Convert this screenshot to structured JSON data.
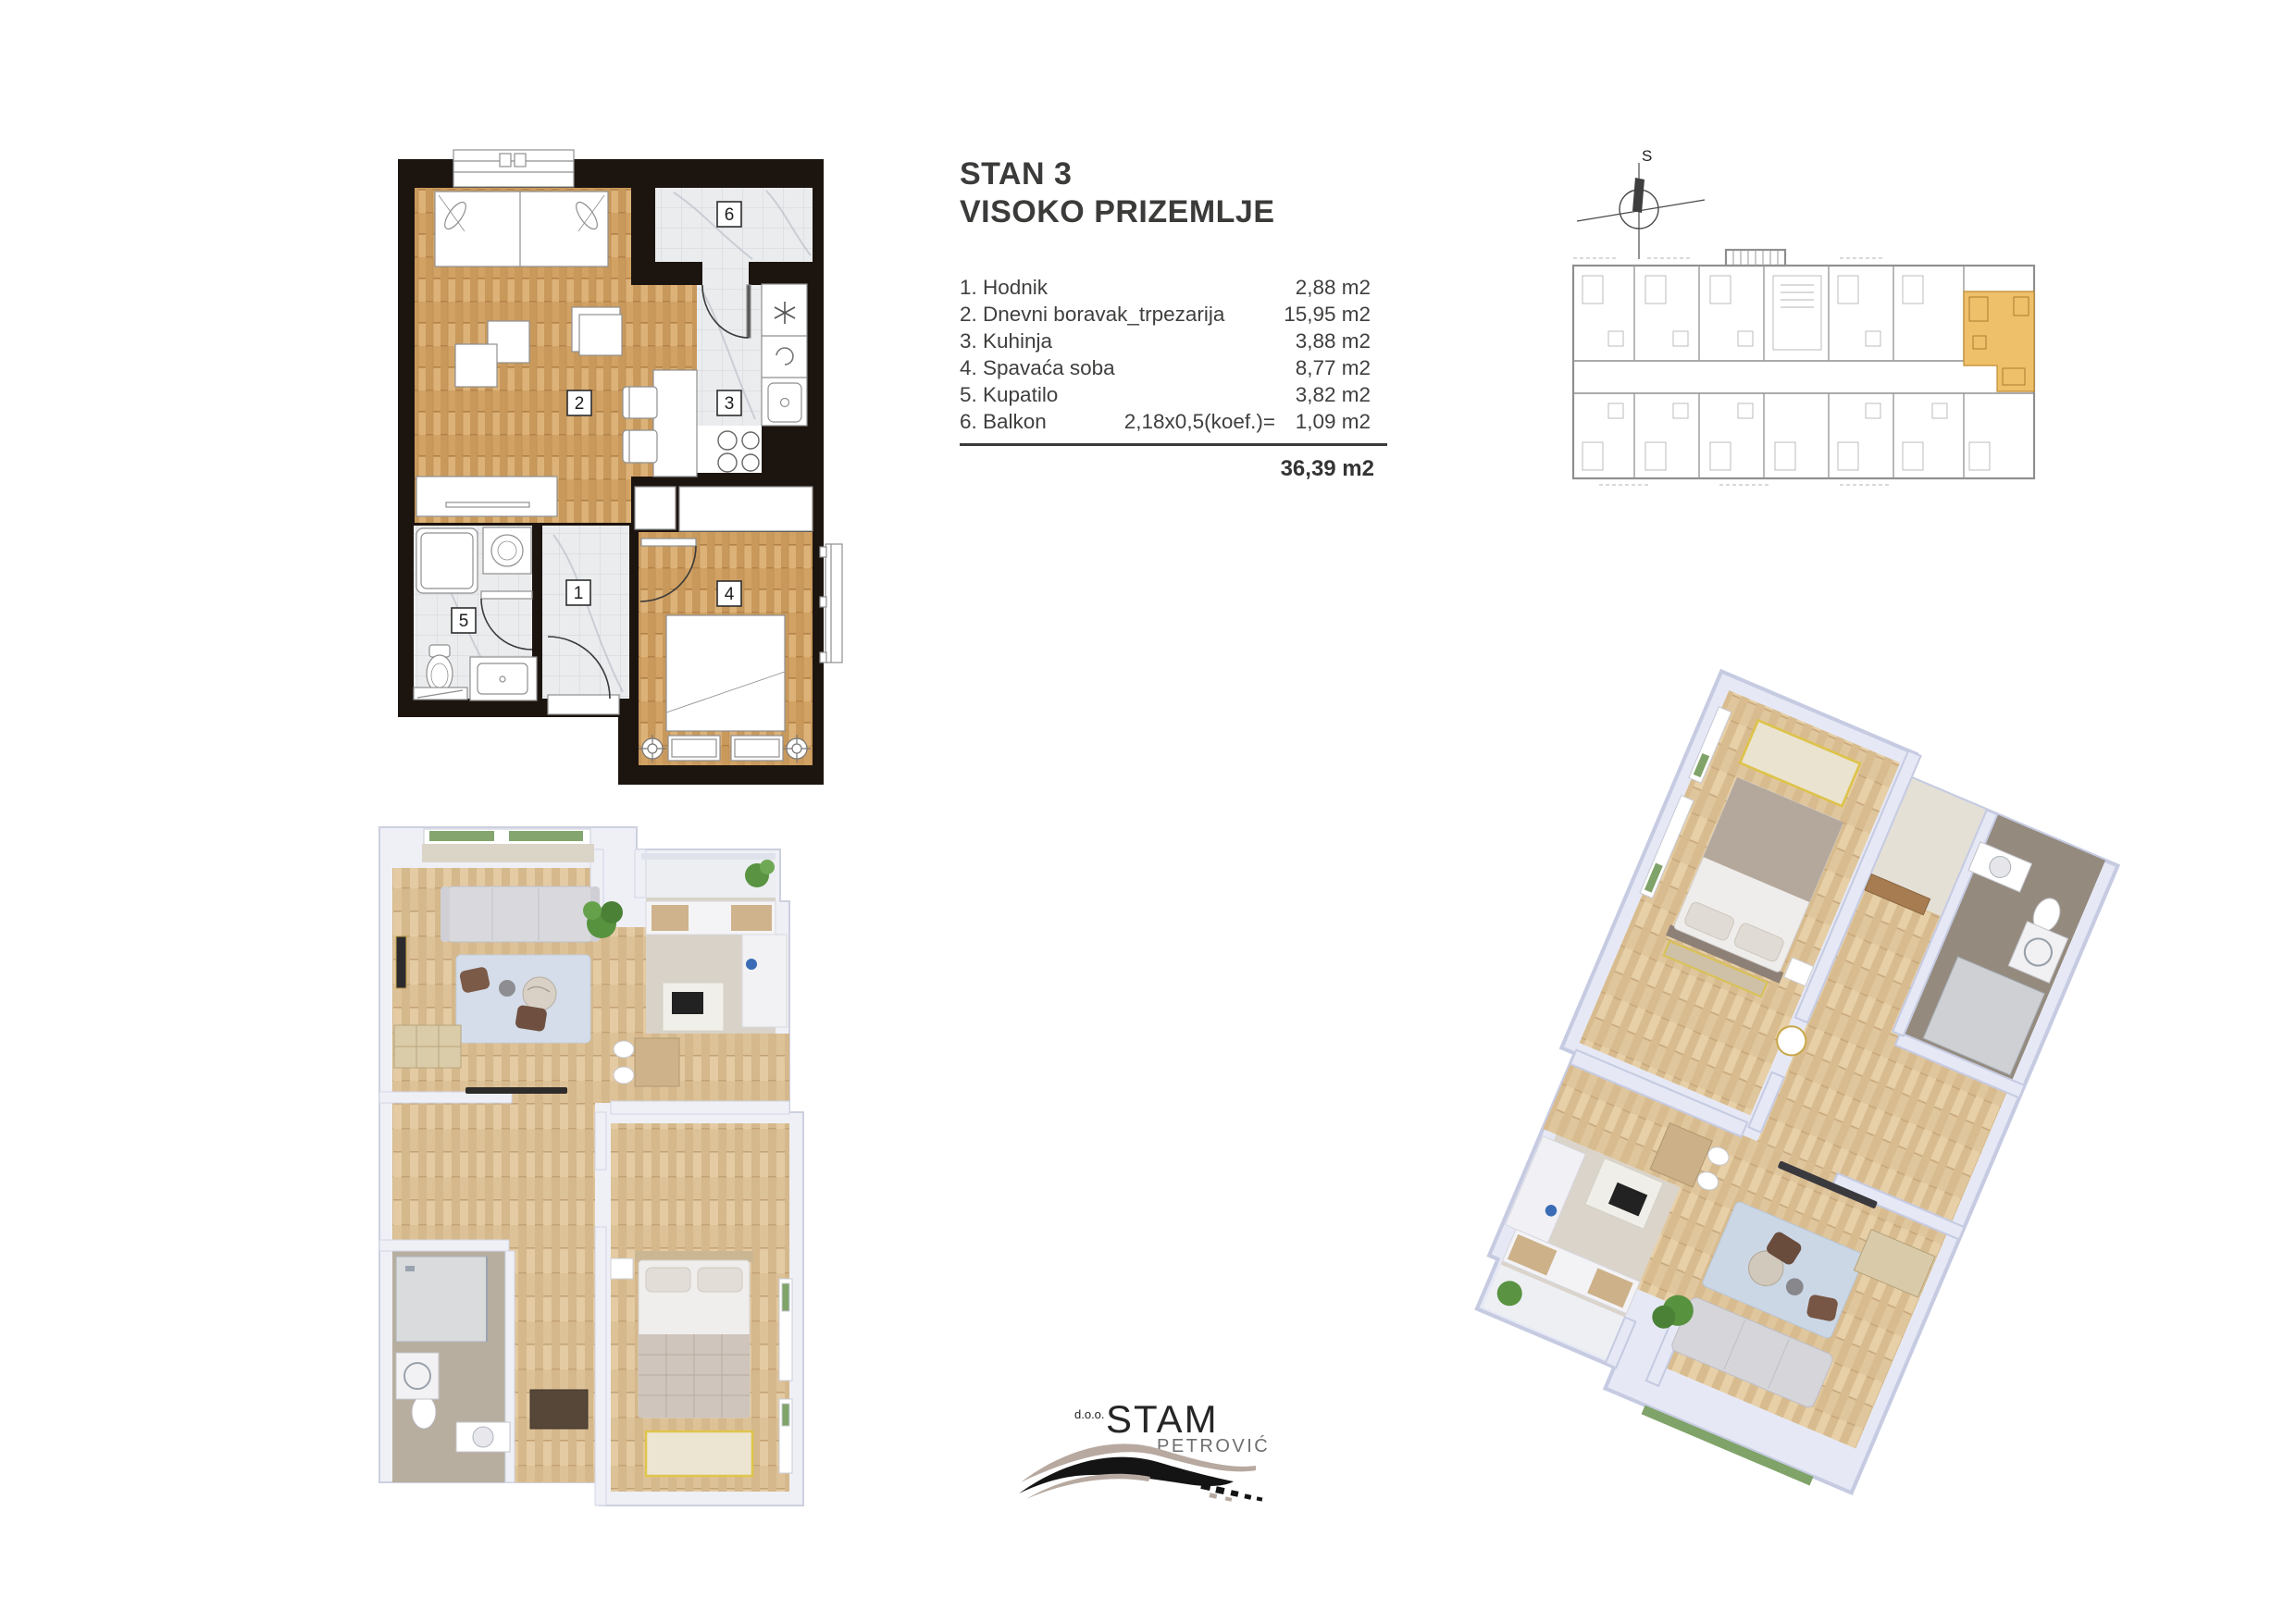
{
  "page": {
    "background": "#ffffff"
  },
  "info": {
    "title": "STAN 3",
    "subtitle": "VISOKO PRIZEMLJE",
    "rooms": [
      {
        "label": "1. Hodnik",
        "formula": "",
        "area": "2,88 m2"
      },
      {
        "label": "2. Dnevni boravak_trpezarija",
        "formula": "",
        "area": "15,95 m2"
      },
      {
        "label": "3. Kuhinja",
        "formula": "",
        "area": "3,88 m2"
      },
      {
        "label": "4. Spavaća soba",
        "formula": "",
        "area": "8,77 m2"
      },
      {
        "label": "5. Kupatilo",
        "formula": "",
        "area": "3,82 m2"
      },
      {
        "label": "6. Balkon",
        "formula": "2,18x0,5(koef.)=",
        "area": "1,09 m2"
      }
    ],
    "total": "36,39 m2"
  },
  "plan2d": {
    "labels": [
      "1",
      "2",
      "3",
      "4",
      "5",
      "6"
    ],
    "colors": {
      "wall": "#1c140f",
      "wood": "#d1a263",
      "tile": "#ebecee"
    }
  },
  "key_plan": {
    "compass_label": "S",
    "highlight_color": "#eec06a"
  },
  "logo": {
    "prefix": "d.o.o.",
    "name": "STAM",
    "surname": "PETROVIĆ"
  }
}
